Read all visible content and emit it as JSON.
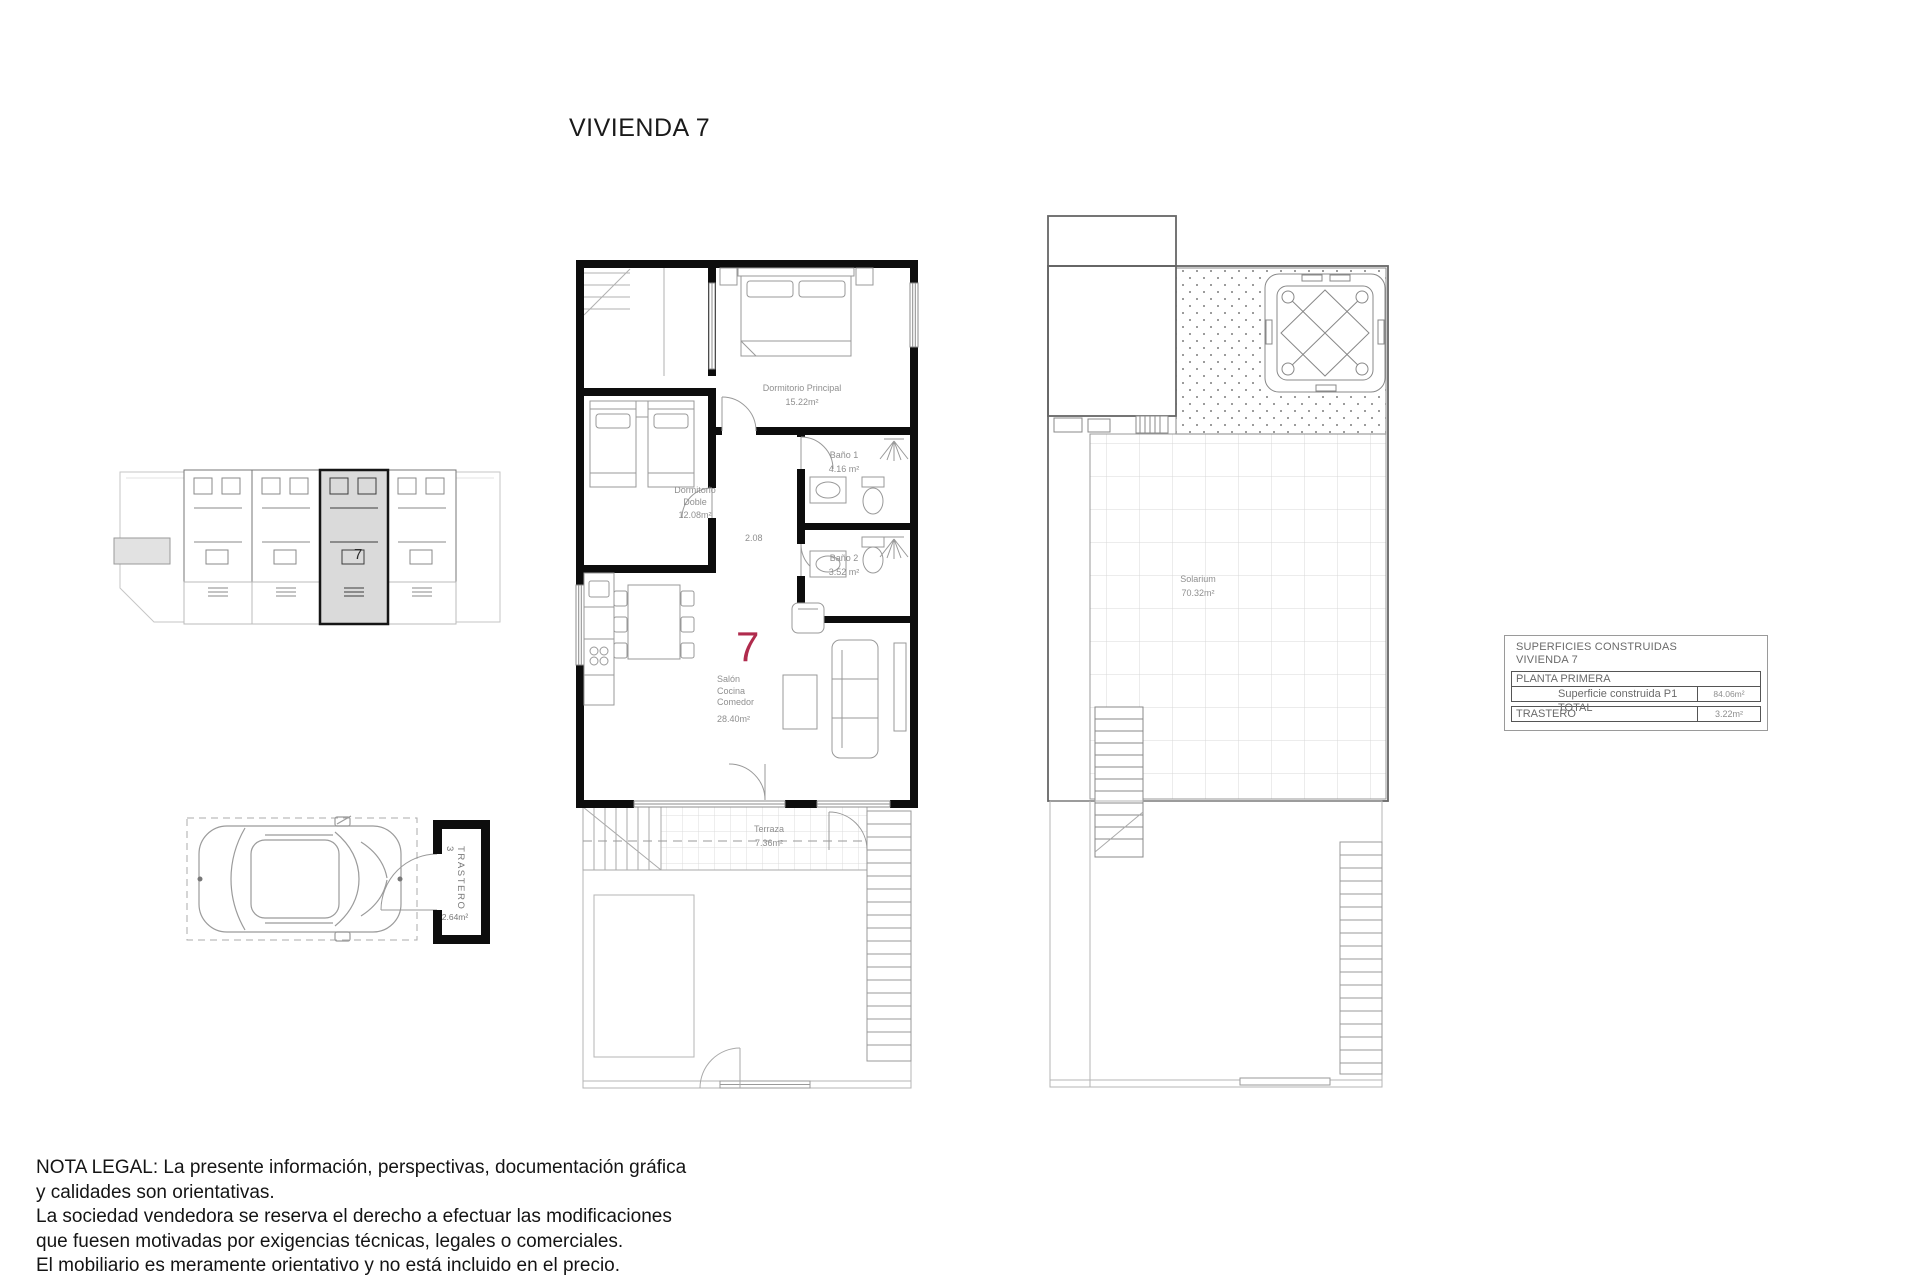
{
  "page": {
    "title": "VIVIENDA 7"
  },
  "colors": {
    "accent": "#b02b4d",
    "wall": "#0d0d0d",
    "label_gray": "#8f8f8f"
  },
  "key_plan": {
    "unit_number": "7"
  },
  "parking": {
    "trastero_label": "TRASTERO 3",
    "trastero_area": "2.64m²"
  },
  "main_plan": {
    "unit_number": "7",
    "dimension": "2.08",
    "rooms": {
      "dormitorio_principal": {
        "name": "Dormitorio Principal",
        "area": "15.22m²"
      },
      "bano1": {
        "name": "Baño 1",
        "area": "4.16 m²"
      },
      "dormitorio_doble": {
        "name": "Dormitorio\nDoble",
        "area": "12.08m²"
      },
      "bano2": {
        "name": "Baño 2",
        "area": "3.52 m²"
      },
      "salon": {
        "name": "Salón\nCocina\nComedor",
        "area": "28.40m²"
      },
      "terraza": {
        "name": "Terraza",
        "area": "7.36m²"
      }
    }
  },
  "solarium_plan": {
    "room": {
      "name": "Solarium",
      "area": "70.32m²"
    }
  },
  "areas_table": {
    "header_line1": "SUPERFICIES CONSTRUIDAS",
    "header_line2": "VIVIENDA 7",
    "planta_label": "PLANTA PRIMERA",
    "total_label": "Superficie construida P1 TOTAL",
    "total_value": "84.06m²",
    "trastero_label": "TRASTERO",
    "trastero_value": "3.22m²"
  },
  "legal_note": {
    "lines": [
      "NOTA LEGAL: La presente información, perspectivas, documentación gráfica",
      "y calidades son orientativas.",
      "La sociedad vendedora se reserva el derecho a efectuar las modificaciones",
      "que fuesen motivadas por exigencias técnicas, legales o comerciales.",
      "El mobiliario es meramente orientativo y no está incluido en el precio."
    ]
  }
}
